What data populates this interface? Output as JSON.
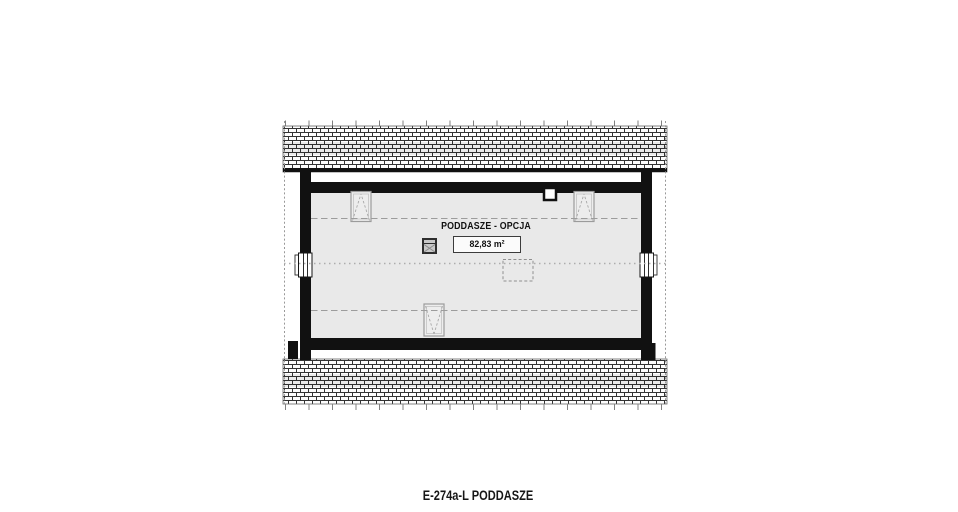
{
  "labels": {
    "room_name": "PODDASZE - OPCJA",
    "room_area": "82,83 m²",
    "caption": "E-274a-L PODDASZE"
  },
  "colors": {
    "wall": "#111111",
    "floor_fill": "#e9e9e9",
    "roof_hatch_line": "#333333",
    "knee_dash_line": "#9c9c9c",
    "centerline": "#adadad"
  },
  "symbols": [
    "roof-window-top-left",
    "roof-window-top-right",
    "roof-window-bottom",
    "gable-window-left",
    "gable-window-right",
    "chimney",
    "flue-stack",
    "ceiling-hatch-opening"
  ]
}
